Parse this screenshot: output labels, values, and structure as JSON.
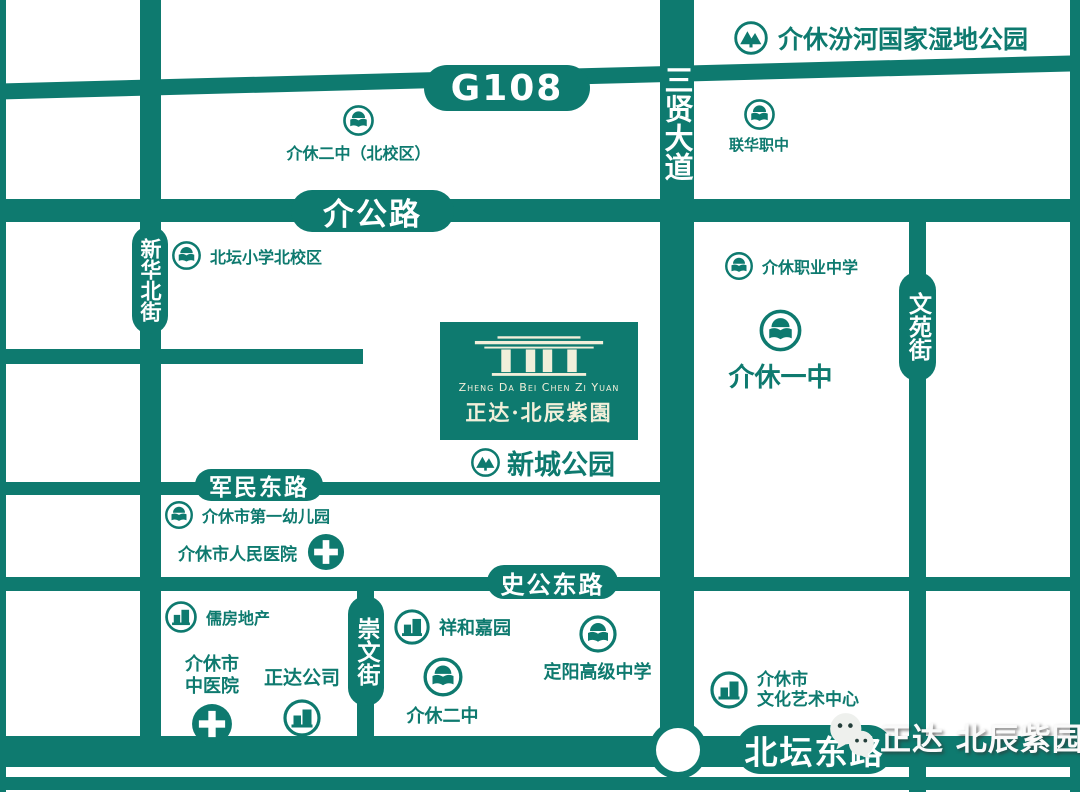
{
  "colors": {
    "road_teal": "#0e7a6f",
    "logo_cream": "#f2efda",
    "background": "#ffffff",
    "watermark_text": "#fafafa"
  },
  "roads": {
    "g108": "G108",
    "san_xian_da_dao": "三贤大道",
    "jie_gong_lu": "介公路",
    "xin_hua_bei_jie": "新华北街",
    "wen_yuan_jie": "文苑街",
    "jun_min_dong_lu": "军民东路",
    "shi_gong_dong_lu": "史公东路",
    "chong_wen_jie": "崇文街",
    "bei_tan_dong_lu": "北坛东路"
  },
  "project": {
    "name_en": "Zheng Da Bei Chen Zi Yuan",
    "name_cn": "正达·北辰紫園"
  },
  "pois": {
    "wetland_park": "介休汾河国家湿地公园",
    "jiexiu_no2_north": "介休二中（北校区）",
    "lianhua_vocational": "联华职中",
    "beitan_primary_north": "北坛小学北校区",
    "jiexiu_vocational": "介休职业中学",
    "jiexiu_no1": "介休一中",
    "xincheng_park": "新城公园",
    "first_kindergarten": "介休市第一幼儿园",
    "peoples_hospital": "介休市人民医院",
    "rufang_realty": "儒房地产",
    "tcm_hospital": "介休市\n中医院",
    "zhengda_company": "正达公司",
    "xianghe_jiayuan": "祥和嘉园",
    "jiexiu_no2": "介休二中",
    "dingyang_high": "定阳高级中学",
    "culture_center": "介休市\n文化艺术中心"
  },
  "icons": {
    "school": "school-icon",
    "park": "park-icon",
    "hospital": "hospital-cross-icon",
    "building": "building-icon",
    "wechat": "wechat-icon"
  },
  "watermark": {
    "text": "正达 北辰紫园"
  }
}
